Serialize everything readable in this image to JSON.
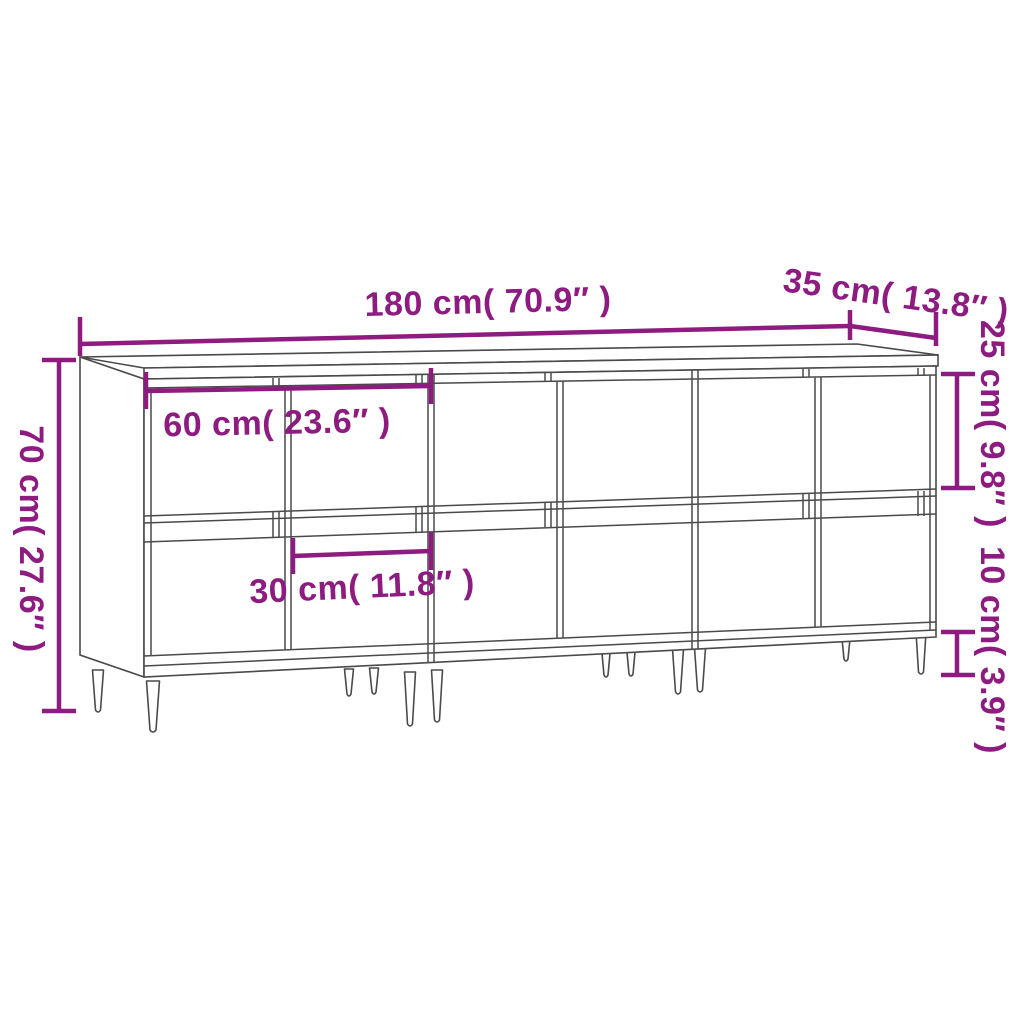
{
  "diagram": {
    "subject": "three-sideboard set line drawing with measurements",
    "accent_color": "#8e1b80",
    "line_color": "#4a4a4a",
    "background_color": "#ffffff",
    "dimensions": {
      "total_width": "180 cm( 70.9″ )",
      "depth": "35 cm( 13.8″ )",
      "upper_door_height": "25 cm( 9.8″ )",
      "total_height": "70 cm( 27.6″ )",
      "unit_width": "60 cm( 23.6″ )",
      "door_width": "30 cm( 11.8″ )",
      "leg_height": "10 cm( 3.9″ )"
    }
  }
}
